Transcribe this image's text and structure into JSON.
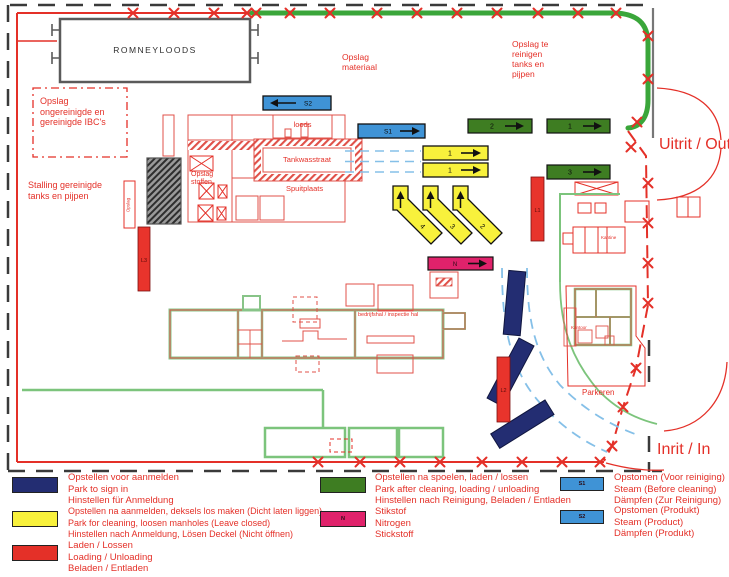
{
  "colors": {
    "red": "#e43028",
    "route_green": "#3aa63a",
    "green_bar": "#3e7d22",
    "blue_bar": "#3f93d6",
    "dark_blue": "#232d72",
    "yellow": "#f8f13c",
    "pink": "#e0226b",
    "line_green": "#7cc47c",
    "light_blue": "#85c0e8",
    "boundary_black": "#3a3a3a",
    "building_gray": "#5a5a5a"
  },
  "map": {
    "buildings": {
      "romneyloods": "ROMNEYLOODS",
      "loods": "loods",
      "tankwasstraat": "Tankwasstraat",
      "spuitplaats": "Spuitplaats",
      "bedrijfshal": "bedrijfshal / inspectie hal",
      "kantine": "Kantine",
      "kantoor": "Kantoor"
    },
    "areas": {
      "opslag_ibc": "Opslag ongereinigde en gereinigde IBC's",
      "stalling": "Stalling gereinigde tanks en pijpen",
      "opslag_materiaal": "Opslag materiaal",
      "opslag_te_reinigen": "Opslag te reinigen tanks en pijpen",
      "opslag_stoffen": "Opslag stoffen",
      "opslag_klein": "Opslag",
      "parkeren": "Parkeren"
    },
    "gates": {
      "exit": "Uitrit / Out",
      "entrance": "Inrit / In"
    },
    "markers": {
      "s1": "S1",
      "s2": "S2",
      "n": "N",
      "l1": "L1",
      "l2": "L2",
      "l3": "L3",
      "green_1": "1",
      "green_2": "2",
      "green_3": "3",
      "yellow_1a": "1",
      "yellow_1b": "1",
      "diag_2": "2",
      "diag_3": "3",
      "diag_4": "4"
    }
  },
  "legend": {
    "items": [
      {
        "key": "sign_in",
        "color": "#232d72",
        "label": "",
        "lines": [
          "Opstellen voor aanmelden",
          "Park to sign in",
          "Hinstellen für Anmeldung"
        ]
      },
      {
        "key": "park_cleaning",
        "color": "#f8f13c",
        "label": "",
        "lines": [
          "Opstellen na aanmelden, deksels los maken (Dicht laten liggen)",
          "Park for cleaning, loosen manholes (Leave closed)",
          "Hinstellen nach Anmeldung, Lösen Deckel (Nicht öffnen)"
        ]
      },
      {
        "key": "loading",
        "color": "#e43028",
        "label": "",
        "lines": [
          "Laden / Lossen",
          "Loading / Unloading",
          "Beladen / Entladen"
        ]
      },
      {
        "key": "after_cleaning",
        "color": "#3e7d22",
        "label": "",
        "lines": [
          "Opstellen na spoelen, laden / lossen",
          "Park after cleaning, loading / unloading",
          "Hinstellen nach Reinigung, Beladen / Entladen"
        ]
      },
      {
        "key": "nitrogen",
        "color": "#e0226b",
        "label": "N",
        "lines": [
          "Stikstof",
          "Nitrogen",
          "Stickstoff"
        ]
      },
      {
        "key": "steam_before",
        "color": "#3f93d6",
        "label": "S1",
        "lines": [
          "Opstomen (Voor reiniging)",
          "Steam (Before cleaning)",
          "Dämpfen (Zur Reinigung)"
        ]
      },
      {
        "key": "steam_product",
        "color": "#3f93d6",
        "label": "S2",
        "lines": [
          "Opstomen (Produkt)",
          "Steam (Product)",
          "Dämpfen (Produkt)"
        ]
      }
    ]
  }
}
